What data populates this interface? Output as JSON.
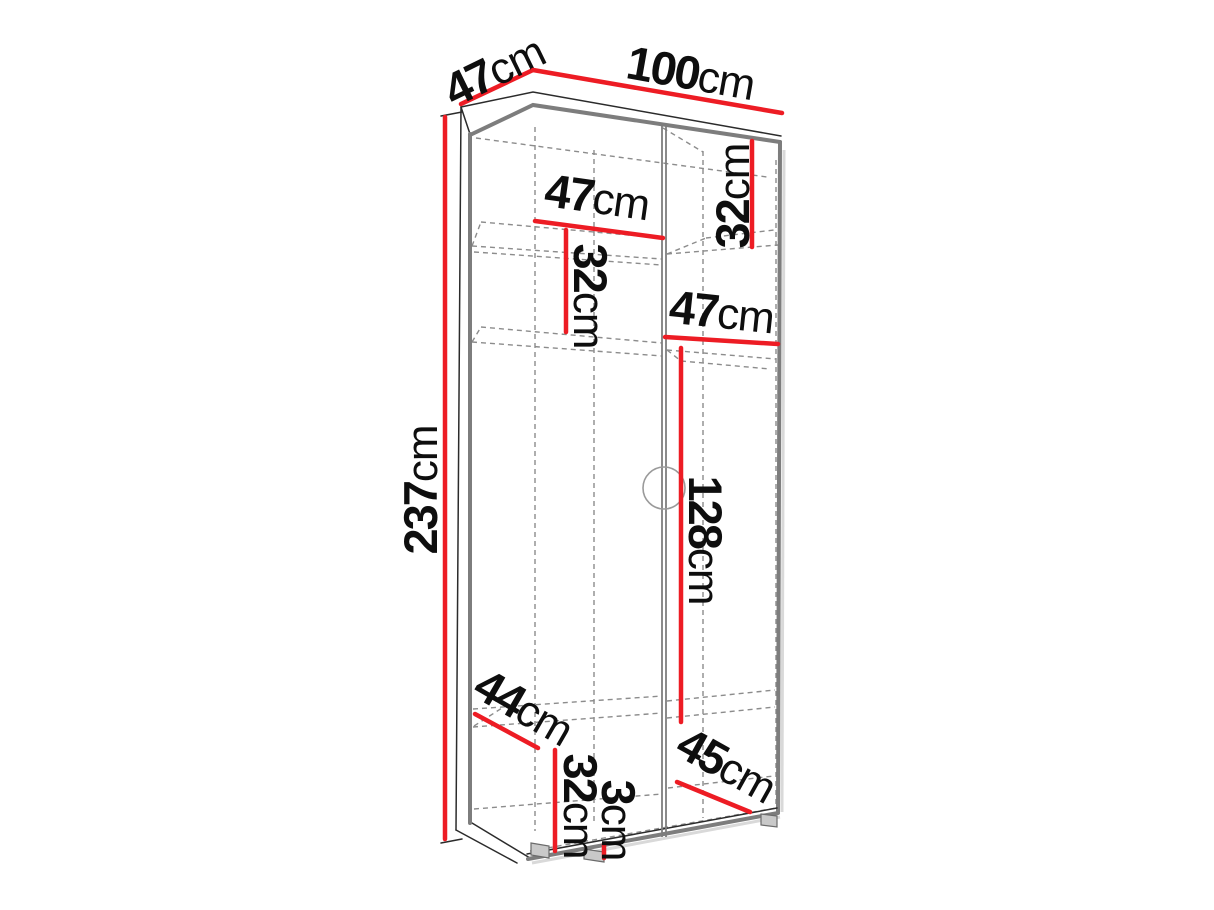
{
  "figure": {
    "type": "furniture-dimension-diagram",
    "subject": "two-door wardrobe, perspective line drawing with red dimension lines"
  },
  "colors": {
    "dimension_line": "#ED1C24",
    "outline": "#2b2b2b",
    "panel_edge": "#7d7d7d",
    "hidden_line": "#8c8c8c",
    "label_text": "#0e0e0e"
  },
  "dimensions": [
    {
      "id": "depth-top",
      "value": "47",
      "unit": "cm"
    },
    {
      "id": "width-top",
      "value": "100",
      "unit": "cm"
    },
    {
      "id": "height-left",
      "value": "237",
      "unit": "cm"
    },
    {
      "id": "upper-shelf-width-left",
      "value": "47",
      "unit": "cm"
    },
    {
      "id": "upper-shelf-height-left",
      "value": "32",
      "unit": "cm"
    },
    {
      "id": "upper-shelf-height-right",
      "value": "32",
      "unit": "cm"
    },
    {
      "id": "shelf-width-right",
      "value": "47",
      "unit": "cm"
    },
    {
      "id": "middle-section-height",
      "value": "128",
      "unit": "cm"
    },
    {
      "id": "bottom-depth-left",
      "value": "44",
      "unit": "cm"
    },
    {
      "id": "bottom-section-height",
      "value": "32",
      "unit": "cm"
    },
    {
      "id": "plinth-gap-height",
      "value": "3",
      "unit": "cm"
    },
    {
      "id": "bottom-shelf-width-right",
      "value": "45",
      "unit": "cm"
    }
  ]
}
